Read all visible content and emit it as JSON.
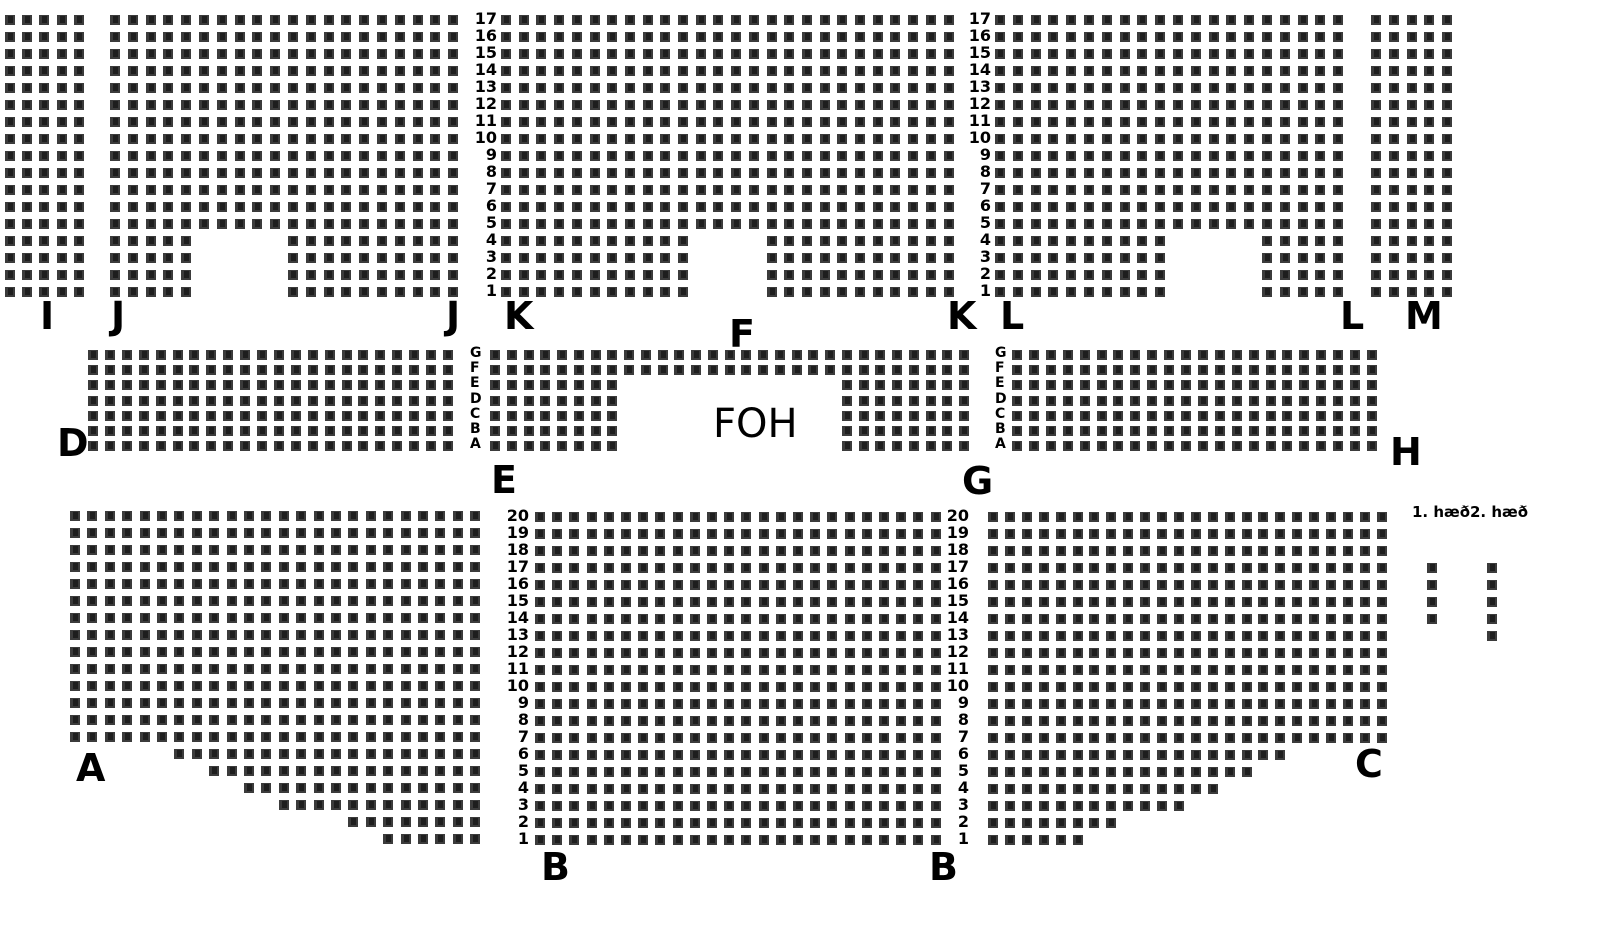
{
  "canvas": {
    "width": 1610,
    "height": 950,
    "background": "#ffffff"
  },
  "seat_style": {
    "size": 10,
    "color": "#3b3b3b",
    "number_ink": "#181818"
  },
  "sections": [
    {
      "id": "I",
      "x": 5,
      "y": 15,
      "cols": 5,
      "rows": 17,
      "px": 17.2,
      "py": 17,
      "overrides": {}
    },
    {
      "id": "J",
      "x": 110,
      "y": 15,
      "cols": 20,
      "rows": 17,
      "px": 17.8,
      "py": 17,
      "overrides": {
        "1": [
          [
            1,
            5
          ],
          [
            11,
            20
          ]
        ],
        "2": [
          [
            1,
            5
          ],
          [
            11,
            20
          ]
        ],
        "3": [
          [
            1,
            5
          ],
          [
            11,
            20
          ]
        ],
        "4": [
          [
            1,
            5
          ],
          [
            11,
            20
          ]
        ]
      }
    },
    {
      "id": "K-F",
      "x": 501,
      "y": 15,
      "cols": 26,
      "rows": 17,
      "px": 17.7,
      "py": 17,
      "overrides": {
        "1": [
          [
            1,
            11
          ],
          [
            16,
            26
          ]
        ],
        "2": [
          [
            1,
            11
          ],
          [
            16,
            26
          ]
        ],
        "3": [
          [
            1,
            11
          ],
          [
            16,
            26
          ]
        ],
        "4": [
          [
            1,
            11
          ],
          [
            16,
            26
          ]
        ]
      }
    },
    {
      "id": "L",
      "x": 995,
      "y": 15,
      "cols": 20,
      "rows": 17,
      "px": 17.8,
      "py": 17,
      "overrides": {
        "1": [
          [
            1,
            10
          ],
          [
            16,
            20
          ]
        ],
        "2": [
          [
            1,
            10
          ],
          [
            16,
            20
          ]
        ],
        "3": [
          [
            1,
            10
          ],
          [
            16,
            20
          ]
        ],
        "4": [
          [
            1,
            10
          ],
          [
            16,
            20
          ]
        ]
      }
    },
    {
      "id": "M",
      "x": 1371,
      "y": 15,
      "cols": 5,
      "rows": 17,
      "px": 17.75,
      "py": 17,
      "overrides": {}
    },
    {
      "id": "D",
      "x": 88,
      "y": 350,
      "cols": 22,
      "rows": 7,
      "px": 16.9,
      "py": 15.2,
      "overrides": {}
    },
    {
      "id": "E-FOH-G",
      "x": 490,
      "y": 350,
      "cols": 29,
      "rows": 7,
      "px": 16.75,
      "py": 15.2,
      "overrides": {
        "1": [
          [
            1,
            8
          ],
          [
            22,
            29
          ]
        ],
        "2": [
          [
            1,
            8
          ],
          [
            22,
            29
          ]
        ],
        "3": [
          [
            1,
            8
          ],
          [
            22,
            29
          ]
        ],
        "4": [
          [
            1,
            8
          ],
          [
            22,
            29
          ]
        ],
        "5": [
          [
            1,
            8
          ],
          [
            22,
            29
          ]
        ]
      }
    },
    {
      "id": "H",
      "x": 1012,
      "y": 350,
      "cols": 22,
      "rows": 7,
      "px": 16.9,
      "py": 15.2,
      "overrides": {}
    },
    {
      "id": "A",
      "x": 70,
      "y": 511,
      "cols": 24,
      "rows": 20,
      "px": 17.4,
      "py": 17,
      "overrides": {
        "6": [
          [
            7,
            24
          ]
        ],
        "5": [
          [
            9,
            24
          ]
        ],
        "4": [
          [
            11,
            24
          ]
        ],
        "3": [
          [
            13,
            24
          ]
        ],
        "2": [
          [
            17,
            24
          ]
        ],
        "1": [
          [
            19,
            24
          ]
        ]
      }
    },
    {
      "id": "B",
      "x": 535,
      "y": 512,
      "cols": 24,
      "rows": 20,
      "px": 17.2,
      "py": 17,
      "overrides": {}
    },
    {
      "id": "C",
      "x": 988,
      "y": 512,
      "cols": 24,
      "rows": 20,
      "px": 16.9,
      "py": 17,
      "overrides": {
        "6": [
          [
            1,
            18
          ]
        ],
        "5": [
          [
            1,
            16
          ]
        ],
        "4": [
          [
            1,
            14
          ]
        ],
        "3": [
          [
            1,
            12
          ]
        ],
        "2": [
          [
            1,
            8
          ]
        ],
        "1": [
          [
            1,
            6
          ]
        ]
      }
    },
    {
      "id": "floor-1",
      "x": 1427,
      "y": 563,
      "cols": 1,
      "rows": 4,
      "px": 17,
      "py": 17,
      "overrides": {}
    },
    {
      "id": "floor-2",
      "x": 1487,
      "y": 563,
      "cols": 1,
      "rows": 5,
      "px": 17,
      "py": 17,
      "overrides": {}
    }
  ],
  "section_labels": [
    {
      "text": "I",
      "x": 40,
      "y": 297
    },
    {
      "text": "J",
      "x": 111,
      "y": 297
    },
    {
      "text": "J",
      "x": 446,
      "y": 297
    },
    {
      "text": "K",
      "x": 504,
      "y": 297
    },
    {
      "text": "F",
      "x": 729,
      "y": 315
    },
    {
      "text": "K",
      "x": 947,
      "y": 297
    },
    {
      "text": "L",
      "x": 1000,
      "y": 297
    },
    {
      "text": "L",
      "x": 1340,
      "y": 297
    },
    {
      "text": "M",
      "x": 1405,
      "y": 297
    },
    {
      "text": "D",
      "x": 57,
      "y": 424
    },
    {
      "text": "E",
      "x": 491,
      "y": 461
    },
    {
      "text": "FOH",
      "x": 713,
      "y": 404,
      "size": 40,
      "weight": 400
    },
    {
      "text": "G",
      "x": 962,
      "y": 462
    },
    {
      "text": "H",
      "x": 1390,
      "y": 433
    },
    {
      "text": "A",
      "x": 76,
      "y": 749
    },
    {
      "text": "B",
      "x": 541,
      "y": 848
    },
    {
      "text": "B",
      "x": 929,
      "y": 848
    },
    {
      "text": "C",
      "x": 1355,
      "y": 745
    }
  ],
  "row_label_columns": [
    {
      "id": "top-rows-left",
      "values": [
        "17",
        "16",
        "15",
        "14",
        "13",
        "12",
        "11",
        "10",
        "9",
        "8",
        "7",
        "6",
        "5",
        "4",
        "3",
        "2",
        "1"
      ],
      "x": 497,
      "align": "right",
      "y": 15,
      "pitch": 17,
      "size": 16
    },
    {
      "id": "top-rows-right",
      "values": [
        "17",
        "16",
        "15",
        "14",
        "13",
        "12",
        "11",
        "10",
        "9",
        "8",
        "7",
        "6",
        "5",
        "4",
        "3",
        "2",
        "1"
      ],
      "x": 991,
      "align": "right",
      "y": 15,
      "pitch": 17,
      "size": 16
    },
    {
      "id": "mid-rows-left",
      "values": [
        "G",
        "F",
        "E",
        "D",
        "C",
        "B",
        "A"
      ],
      "x": 470,
      "align": "left",
      "y": 350,
      "pitch": 15.2,
      "size": 14
    },
    {
      "id": "mid-rows-right",
      "values": [
        "G",
        "F",
        "E",
        "D",
        "C",
        "B",
        "A"
      ],
      "x": 995,
      "align": "left",
      "y": 350,
      "pitch": 15.2,
      "size": 14
    },
    {
      "id": "bottom-rows-left",
      "values": [
        "20",
        "19",
        "18",
        "17",
        "16",
        "15",
        "14",
        "13",
        "12",
        "11",
        "10",
        "9",
        "8",
        "7",
        "6",
        "5",
        "4",
        "3",
        "2",
        "1"
      ],
      "x": 529,
      "align": "right",
      "y": 512,
      "pitch": 17,
      "size": 16
    },
    {
      "id": "bottom-rows-right",
      "values": [
        "20",
        "19",
        "18",
        "17",
        "16",
        "15",
        "14",
        "13",
        "12",
        "11",
        "10",
        "9",
        "8",
        "7",
        "6",
        "5",
        "4",
        "3",
        "2",
        "1"
      ],
      "x": 969,
      "align": "right",
      "y": 512,
      "pitch": 17,
      "size": 16
    }
  ],
  "floor_labels": [
    {
      "text": "1. hæð",
      "x": 1412,
      "y": 503,
      "size": 15
    },
    {
      "text": "2. hæð",
      "x": 1470,
      "y": 503,
      "size": 15
    }
  ]
}
